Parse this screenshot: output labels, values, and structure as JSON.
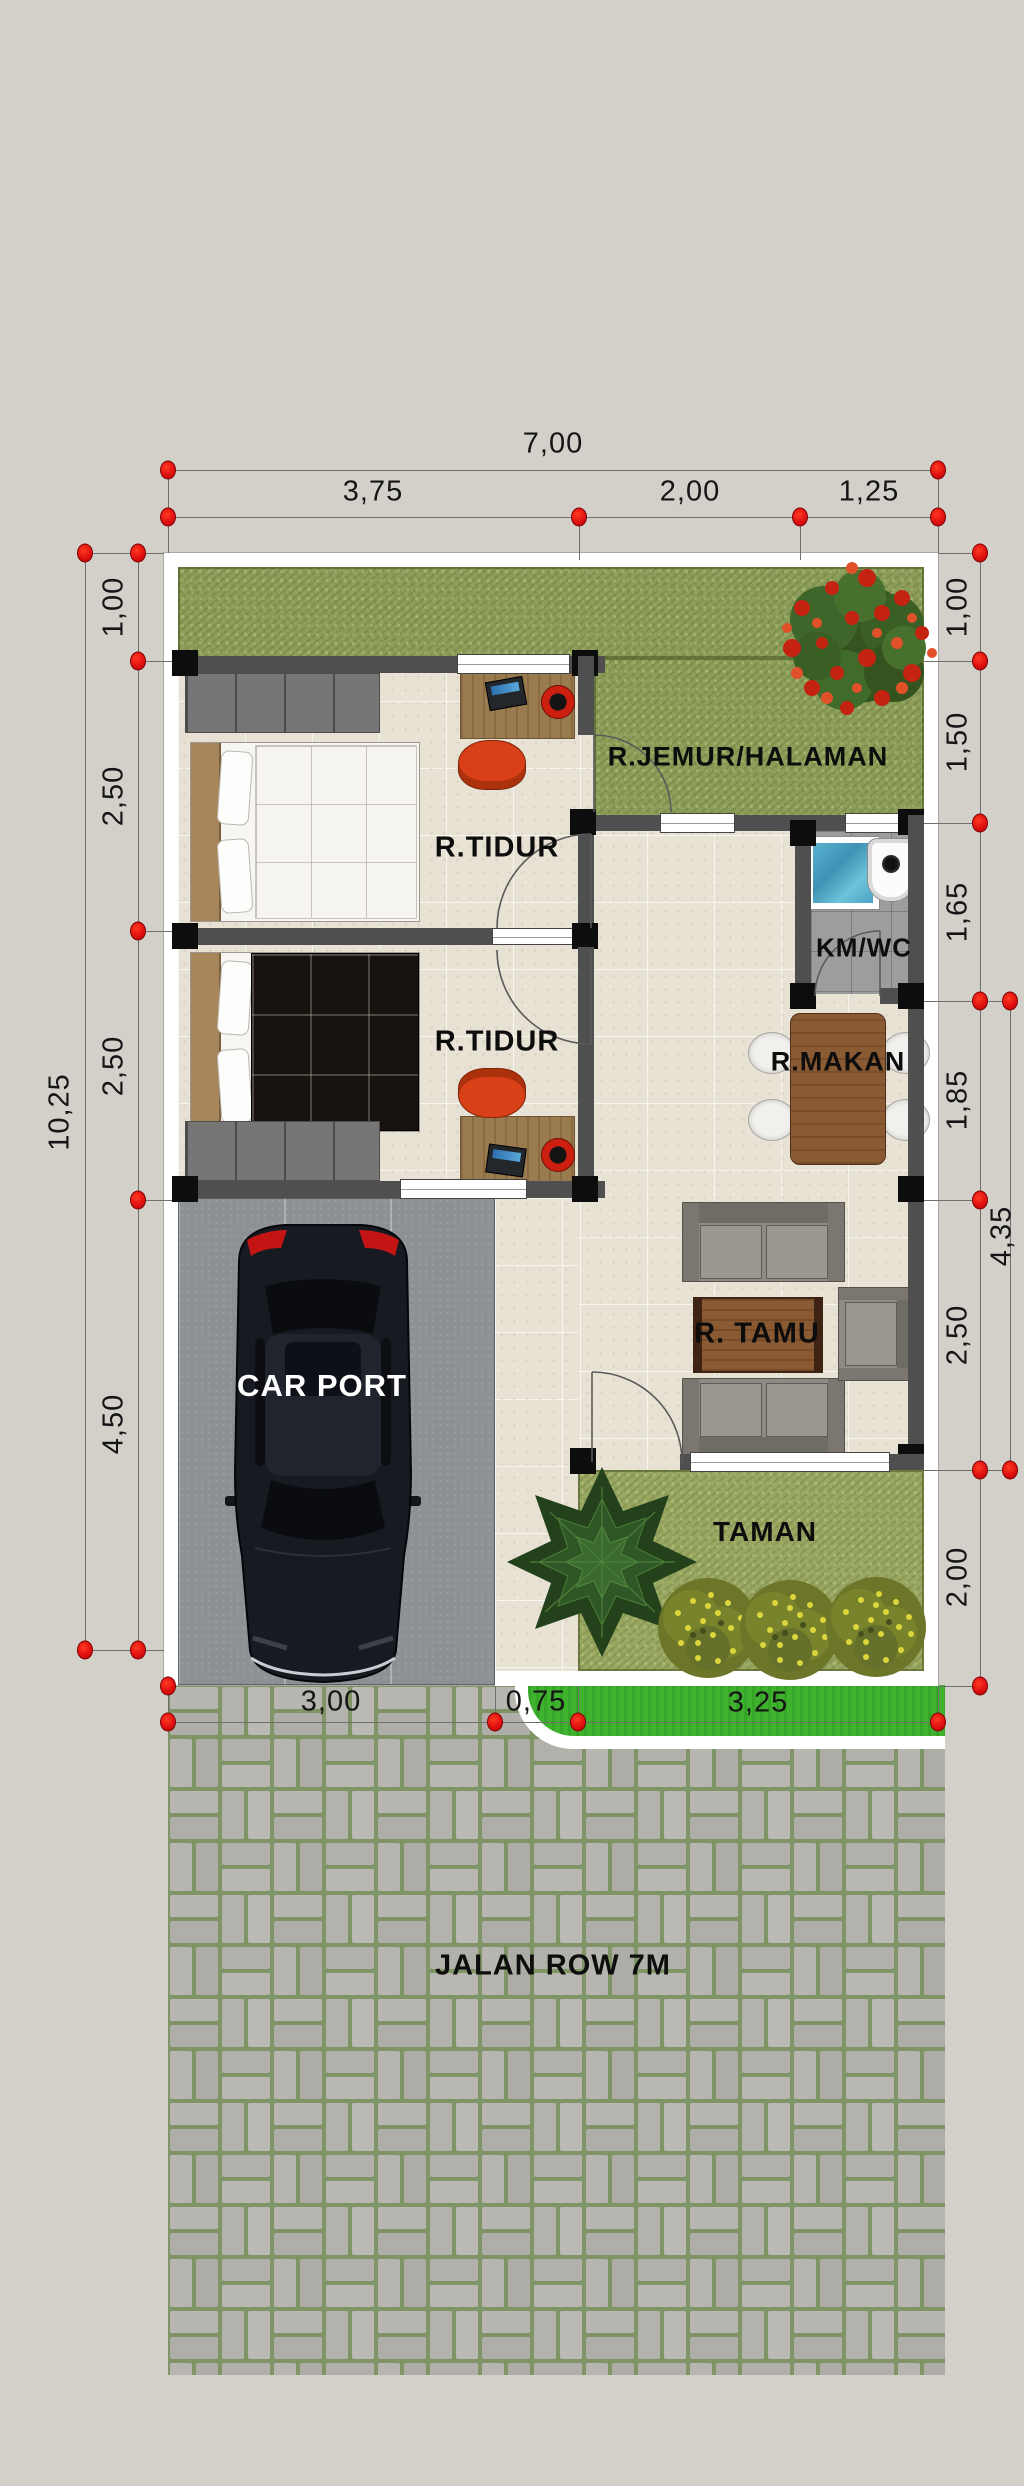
{
  "plan": {
    "rooms": {
      "jemur": "R.JEMUR/HALAMAN",
      "tidur1": "R.TIDUR",
      "tidur2": "R.TIDUR",
      "kmwc": "KM/WC",
      "makan": "R.MAKAN",
      "tamu": "R. TAMU",
      "carport": "CAR PORT",
      "taman": "TAMAN",
      "jalan": "JALAN ROW 7M"
    },
    "dims": {
      "top_total": "7,00",
      "top_segments": [
        "3,75",
        "2,00",
        "1,25"
      ],
      "left_total": "10,25",
      "left_segments": [
        "1,00",
        "2,50",
        "2,50",
        "4,50"
      ],
      "right_segments": [
        "1,00",
        "1,50",
        "1,65",
        "1,85",
        "2,50",
        "2,00"
      ],
      "right_outer": "4,35",
      "bottom_segments": [
        "3,00",
        "0,75",
        "3,25"
      ]
    },
    "colors": {
      "background": "#d2d0c9",
      "marker_red": "#e01010",
      "grass": "#8a9b55",
      "taman_grass": "#97a55e",
      "verge_green": "#3fb32e",
      "floor_tile": "#e8e2d5",
      "wall": "#4f4f4f",
      "wall_block": "#0d0d0d",
      "carport_concrete": "#8d9196",
      "road_brick": "#b5b3ad",
      "road_joint": "#7f9566",
      "wood_table": "#8a5a33",
      "red_chair": "#d84018",
      "water_blue": "#4aa3c4",
      "car_body": "#171a21"
    }
  }
}
